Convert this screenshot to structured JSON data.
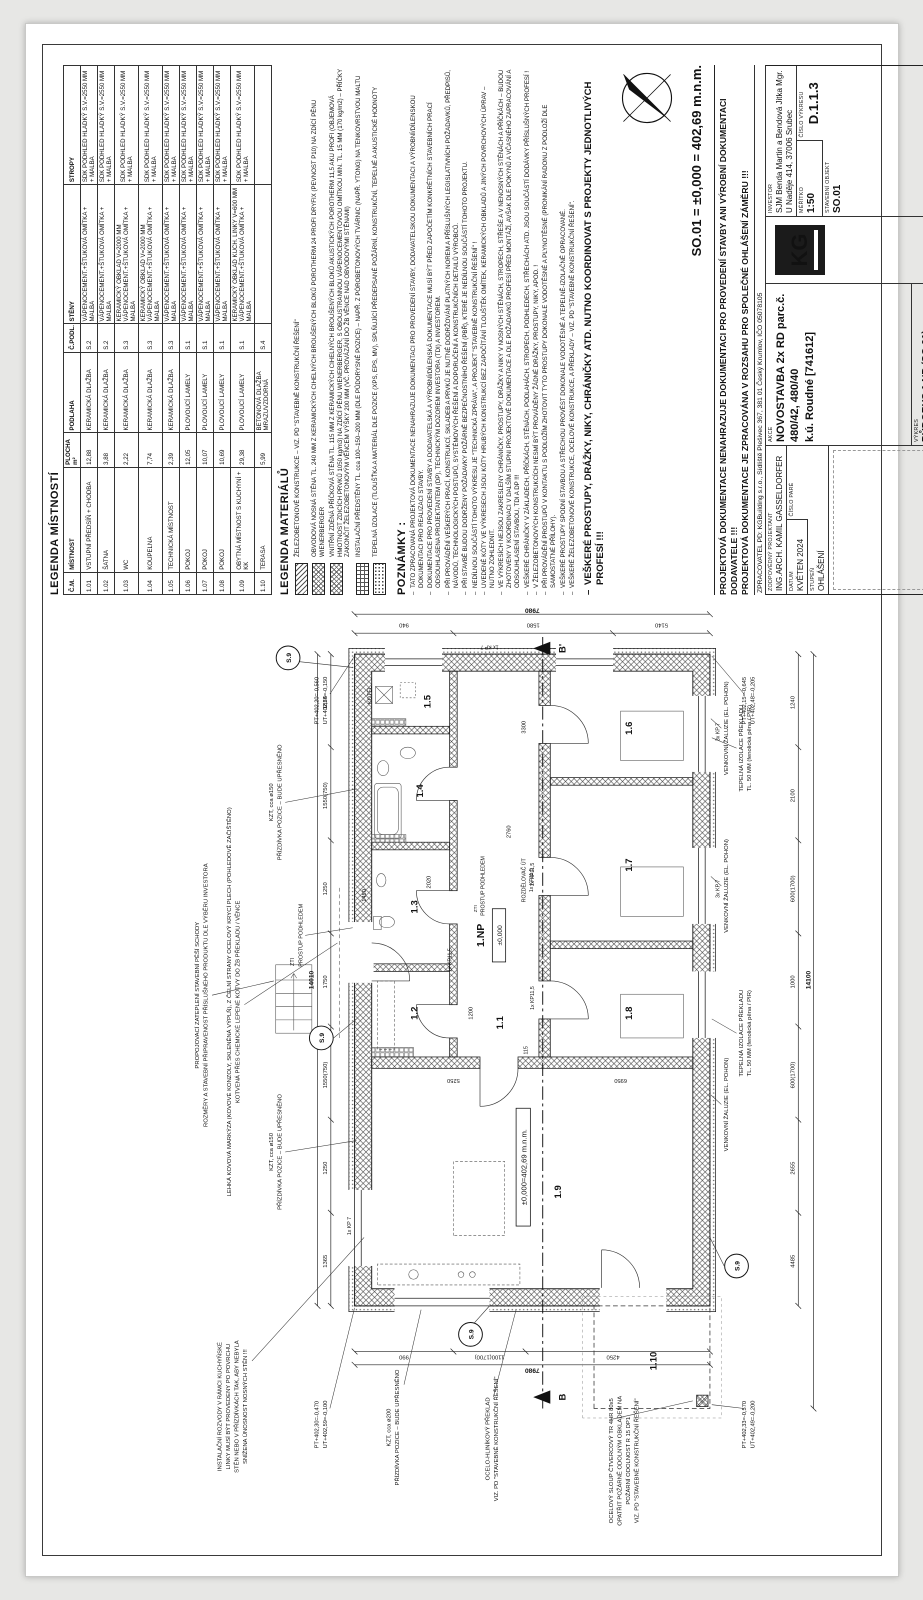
{
  "sheet": {
    "so_line": "SO.01 = ±0,000 = 402,69 m.n.m."
  },
  "room_table": {
    "title": "LEGENDA MÍSTNOSTÍ",
    "headers": [
      "Č.M.",
      "MÍSTNOST",
      "PLOCHA m²",
      "PODLAHA",
      "Č.PODL.",
      "STĚNY",
      "STROPY"
    ],
    "rows": [
      [
        "1.01",
        "VSTUPNÍ PŘEDSÍŇ + CHODBA",
        "12,88",
        "KERAMICKÁ DLAŽBA",
        "S.2",
        "VÁPENOCEMENT.+ŠTUKOVÁ OMÍTKA + MALBA",
        "SDK PODHLED HLADKÝ S.V.=2550 MM + MALBA"
      ],
      [
        "1.02",
        "ŠATNA",
        "3,88",
        "KERAMICKÁ DLAŽBA",
        "S.2",
        "VÁPENOCEMENT.+ŠTUKOVÁ OMÍTKA + MALBA",
        "SDK PODHLED HLADKÝ S.V.=2550 MM + MALBA"
      ],
      [
        "1.03",
        "WC",
        "2,22",
        "KERAMICKÁ DLAŽBA",
        "S.3",
        "KERAMICKÝ OBKLAD V=2000 MM\nVÁPENOCEMENT.+ŠTUKOVÁ OMÍTKA + MALBA",
        "SDK PODHLED HLADKÝ S.V.=2550 MM + MALBA"
      ],
      [
        "1.04",
        "KOUPELNA",
        "7,74",
        "KERAMICKÁ DLAŽBA",
        "S.3",
        "KERAMICKÝ OBKLAD V=2000 MM\nVÁPENOCEMENT.+ŠTUKOVÁ OMÍTKA + MALBA",
        "SDK PODHLED HLADKÝ S.V.=2550 MM + MALBA"
      ],
      [
        "1.05",
        "TECHNICKÁ MÍSTNOST",
        "2,39",
        "KERAMICKÁ DLAŽBA",
        "S.3",
        "VÁPENOCEMENT.+ŠTUKOVÁ OMÍTKA + MALBA",
        "SDK PODHLED HLADKÝ S.V.=2550 MM + MALBA"
      ],
      [
        "1.06",
        "POKOJ",
        "12,05",
        "PLOVOUCÍ LAMELY",
        "S.1",
        "VÁPENOCEMENT.+ŠTUKOVÁ OMÍTKA + MALBA",
        "SDK PODHLED HLADKÝ S.V.=2550 MM + MALBA"
      ],
      [
        "1.07",
        "POKOJ",
        "10,07",
        "PLOVOUCÍ LAMELY",
        "S.1",
        "VÁPENOCEMENT.+ŠTUKOVÁ OMÍTKA + MALBA",
        "SDK PODHLED HLADKÝ S.V.=2550 MM + MALBA"
      ],
      [
        "1.08",
        "POKOJ",
        "10,69",
        "PLOVOUCÍ LAMELY",
        "S.1",
        "VÁPENOCEMENT.+ŠTUKOVÁ OMÍTKA + MALBA",
        "SDK PODHLED HLADKÝ S.V.=2550 MM + MALBA"
      ],
      [
        "1.09",
        "OBYTNÁ MÍSTNOST S KUCHYNÍ + KK",
        "29,38",
        "PLOVOUCÍ LAMELY",
        "S.1",
        "KERAMICKÝ OBKLAD KUCH. LINKY V=600 MM\nVÁPENOCEMENT.+ŠTUKOVÁ OMÍTKA + MALBA",
        "SDK PODHLED HLADKÝ S.V.=2550 MM + MALBA"
      ],
      [
        "1.10",
        "TERASA",
        "5,99",
        "BETONOVÁ DLAŽBA MRAZUVZDORNÁ",
        "S.4",
        "",
        ""
      ]
    ]
  },
  "materials_legend": {
    "title": "LEGENDA MATERIÁLŮ",
    "items": [
      {
        "hatch": "diag",
        "text": "ŽELEZOBETONOVÉ KONSTRUKCE – VIZ. PD \"STAVEBNĚ KONSTRUKČNÍ ŘEŠENÍ\""
      },
      {
        "hatch": "cross",
        "text": "OBVODOVÁ NOSNÁ STĚNA TL. 240 MM Z KERAMICKÝCH CIHELNÝCH BROUŠENÝCH BLOKŮ POROTHERM 24 PROFI DRYFIX (PEVNOST P10) NA ZDÍCÍ PĚNU WIENERBERGER"
      },
      {
        "hatch": "cross",
        "text": "VNITŘNÍ ZDĚNÁ PŘÍČKOVÁ STĚNA TL. 115 MM Z KERAMICKÝCH CIHELNÝCH BROUŠENÝCH BLOKŮ AKUSTICKÝCH POROTHERM 11,5 AKU PROFI (OBJEMOVÁ HMOTNOST ZDICÍCH PRVKŮ 1050 kg/m3) NA ZDÍCÍ PĚNU WIENERBERGER, S OBOUSTRANNOU VÁPENOCEMENTOVOU OMÍTKOU MIN. TL. 15 MM (170 kg/m2) – PŘÍČKY ZAKONČIT ŽELEZOBETONOVÝM VĚNCEM VÝŠKY 200 MM (VČ. PROVÁZÁNÍ DO ŽB VĚNCE NAD OBVODOVÝMI STĚNAMI)"
      },
      {
        "hatch": "blocks",
        "text": "INSTALAČNÍ PŘEDSTĚNY TL. cca 100–150–200 MM (DLE PŮDORYSNÉ POZICE) – NAPŘ. Z PÓROBETONOVÝCH TVÁRNIC (NAPŘ. YTONG) NA TENKOVRSTVOU MALTU"
      },
      {
        "hatch": "dots",
        "text": "TEPELNÁ IZOLACE (TLOUŠŤKA A MATERIÁL DLE POZICE (XPS, EPS, MV), SPLŇUJÍCÍ PŘEDEPSANÉ POŽÁRNÍ, KONSTRUKČNÍ, TEPELNÉ A AKUSTICKÉ HODNOTY"
      }
    ]
  },
  "notes": {
    "title": "POZNÁMKY :",
    "items": [
      "TATO ZPRACOVANÁ PROJEKTOVÁ DOKUMENTACE NENAHRAZUJE DOKUMENTACI PRO PROVEDENÍ STAVBY, DODAVATELSKOU DOKUMENTACI A VÝROBNÍ/DÍLENSKOU DOKUMENTACI PRO REALIZACI STAVBY.",
      "DOKUMENTACE PRO PROVEDENÍ STAVBY A DODAVATELSKÁ A VÝROBNÍ/DÍLENSKÁ DOKUMENTACE MUSÍ BÝT PŘED ZAPOČETÍM KONKRÉTNÍCH STAVEBNÍCH PRACÍ ODSOUHLASENA PROJEKTANTEM (DP), TECHNICKÝM DOZOREM INVESTORA (TDI) A INVESTOREM.",
      "PŘI PROVÁDĚNÍ VEŠKERÝCH PRACÍ, KONSTRUKCÍ, SKLADEB A PRVKŮ JE NUTNÉ DODRŽOVÁNÍ PLATNÝCH NOREM A PŘÍSLUŠNÝCH LEGISLATIVNÍCH POŽADAVKŮ, PŘEDPISŮ, NÁVODŮ, TECHNOLOGICKÝCH POSTUPŮ, SYSTÉMOVÝCH ŘEŠENÍ A DOPORUČENÍ A KONSTRUKČNÍCH DETAILŮ VÝROBCŮ.",
      "PŘI STAVBĚ BUDOU DODRŽENY POŽADAVKY POŽÁRNĚ BEZPEČNOSTNÍHO ŘEŠENÍ (PBŘ), KTERÉ JE NEDÍLNOU SOUČÁSTÍ TOHOTO PROJEKTU.",
      "NEDÍLNOU SOUČÁSTÍ TOHOTO VÝKRESU JE \"TECHNICKÁ ZPRÁVA\", A PROJEKT \"STAVEBNĚ KONSTRUKČNÍ ŘEŠENÍ\" !",
      "UVEDENÉ KÓTY VE VÝKRESECH JSOU KÓTY HRUBÝCH KONSTRUKCÍ BEZ ZAPOČÍTÁNÍ TLOUŠTĚK OMÍTEK, KERAMICKÝCH OBKLADŮ A JINÝCH POVRCHOVÝCH ÚPRAV – NUTNO ZOHLEDNIT.",
      "VE VÝKRESÍCH NEJSOU ZAKRESLENY CHRÁNIČKY, PROSTUPY, DRÁŽKY A NIKY V NOSNÝCH STĚNÁCH, STROPECH, STŘEŠE A V NENOSNÝCH STĚNÁCH A PŘÍČKÁCH – BUDOU ZHOTOVENY V KOORDINACI V DALŠÍM STUPNI PROJEKTOVÉ DOKUMENTACE A DLE POŽADAVKŮ PROFESÍ PŘED MONTÁŽÍ, AVŠAK DLE POKYNŮ A VČASNÉHO ZAPRACOVÁNÍ A ODSOUHLASENÍ STAVBOU, TDI A DP !!!",
      "VEŠKERÉ CHRÁNIČKY V ZÁKLADECH, PŘÍČKÁCH, STĚNÁCH, PODLAHÁCH, STROPECH, PODHLEDECH, STŘECHÁCH ATD. JSOU SOUČÁSTÍ DODÁVKY PŘÍSLUŠNÝCH PROFESÍ !",
      "V ŽELEZOBETONOVÝCH KONSTRUKCÍCH NESMÍ BÝT PROVÁDĚNY ŽÁDNÉ DRÁŽKY, PROSTUPY, NIKY, APOD. !",
      "PŘI PROVÁDĚNÍ PROSTUPŮ V KONTAKTU S PODLOŽÍM ZHOTOVIT TYTO PROSTUPY DOKONALE VODOTĚSNÉ A PLYNOTĚSNÉ (PRONIKÁNÍ RADONU Z PODLOŽÍ DLE SAMOSTATNÉ PŘÍLOHY).",
      "VEŠKERÉ PROSTUPY SPODNÍ STAVBOU A STŘECHOU PROVÉST DOKONALE VODOTĚSNÉ A TEPELNĚ-IZOLAČNĚ OPRACOVANÉ.",
      "VEŠKERÉ ŽELEZOBETONOVÉ KONSTRUKCE, OCELOVÉ KONSTRUKCE, A PŘEKLADY – VIZ. PD \"STAVEBNĚ KONSTRUKČNÍ ŘEŠENÍ\"."
    ],
    "final": "VEŠKERÉ PROSTUPY, DRÁŽKY, NIKY, CHRÁNIČKY ATD. NUTNO KOORDINOVAT S PROJEKTY JEDNOTLIVÝCH PROFESÍ !!!"
  },
  "title_block": {
    "warning1": "PROJEKTOVÁ DOKUMENTACE NENAHRAZUJE DOKUMENTACI PRO PROVEDENÍ STAVBY ANI VÝROBNÍ DOKUMENTACI DODAVATELE !!!",
    "warning2": "PROJEKTOVÁ DOKUMENTACE JE ZPRACOVÁNA V ROZSAHU PRO SPOLEČNÉ OHLÁŠENÍ ZÁMĚRU !!!",
    "zpracovatel": "ZPRACOVATEL PD: KGBuilding s.r.o., Sídliště Plešivec 367, 381 01 Český Krumlov, IČO 05078105",
    "zodpovedny_label": "ZODPOVĚDNÝ PROJEKTANT",
    "zodpovedny": "ING.ARCH. KAMIL GASSELDORFER",
    "datum_label": "DATUM",
    "datum": "KVĚTEN 2024",
    "cislo_pare_label": "ČÍSLO PARÉ",
    "stupen_label": "STUPEŇ",
    "stupen": "OHLÁŠENÍ",
    "akce_label": "AKCE",
    "akce_line1": "NOVOSTAVBA 2x RD parc.č. 480/42, 480/40",
    "akce_line2": "k.ú. Roudné [741612]",
    "vykres_label": "VÝKRES",
    "vykres": "PŮDORYS 1.NP (SO.01)",
    "investor_label": "INVESTOR",
    "investor_line1": "SJM Benda Martin a Bendová Jitka Mgr.",
    "investor_line2": "U Naděje 414, 37006 Srubec",
    "meritko_label": "MĚŘÍTKO",
    "meritko": "1:50",
    "cislo_vykresu_label": "ČÍSLO VÝKRESU",
    "cislo_vykresu": "D.1.1.3",
    "stavebni_objekt_label": "STAVEBNÍ OBJEKT",
    "stavebni_objekt": "SO.01",
    "logo_text": "KG"
  },
  "plan": {
    "rooms": [
      "1.1",
      "1.2",
      "1.3",
      "1.4",
      "1.5",
      "1.6",
      "1.7",
      "1.8",
      "1.9",
      "1.10"
    ],
    "floor_label": "1.NP",
    "level_main": "±0,000=402,69 m.n.m.",
    "level_small": "±0,000",
    "section_marker": "S.9",
    "section_b": "B",
    "section_b2": "B'",
    "dims": {
      "top_overall": "14010",
      "top": [
        "1365",
        "1250",
        "1550(750)",
        "1750",
        "1250",
        "1550(750)",
        "1825"
      ],
      "bottom_overall": "14100",
      "bottom": [
        "4485",
        "2655",
        "600(1700)",
        "1000",
        "600(1700)",
        "2100",
        "1240"
      ],
      "left_overall": "7980",
      "left": [
        "990",
        "1100(1700)",
        "4250"
      ],
      "right_overall": "7980",
      "right": [
        "940",
        "1580",
        "5140"
      ],
      "inner": [
        "5250",
        "6950",
        "1200",
        "2760",
        "3300",
        "1450",
        "115",
        "2020"
      ]
    },
    "corner_levels": [
      {
        "pt": "PT+402,30=-0,470",
        "ut": "UT+402,59=-0,100"
      },
      {
        "pt": "PT+402,33=-0,570",
        "ut": "UT+402,49=-0,200"
      },
      {
        "pt": "PT+402,20=-0,560",
        "ut": "UT+402,54=-0,150"
      },
      {
        "pt": "PT+402,15=-0,645",
        "ut": "UT+402,48=-0,205"
      }
    ],
    "kp_marks": {
      "kp115": "1x KP11,5",
      "kp7": "1x KP 7",
      "kp7_3": "3x KP 7"
    },
    "callouts": {
      "instal": [
        "INSTALAČNÍ ROZVODY V RÁMCI KUCHYŇSKÉ",
        "LINKY MUSÍ BÝT PROVEDENY PO POVRCHU",
        "STĚN NEBO V PŘÍZDÍVKÁCH TAK, ABY NEBYLA",
        "SNÍŽENA ÚNOSNOST NOSNÝCH STĚN !!!"
      ],
      "schody": [
        "PROPOJOVACÍ ZATEPLENÍ STAVEBNÍ PĚŠÍ SCHODY",
        "ROZMĚRY A STAVEBNÍ PŘIPRAVENOST PŘÍSLUŠNÉHO PRODUKTU DLE VÝBĚRU INVESTORA"
      ],
      "markyza": [
        "LEHKÁ KOVOVÁ MARKÝZA (KOVOVÉ KONZOLY, SKLENĚNÁ VÝPLŇ), Z ČELNÍ STRANY OCELOVÝ KRYCÍ PLECH (POHLEDOVĚ ZAČIŠTĚNO)",
        "KOTVENÁ PŘES CHEMICKÉ LEPENÉ KOTVY DO ŽB PŘEKLADU / VĚNCE"
      ],
      "kzt150": [
        "KZT, cca ø150",
        "PŘÍZDÍVKA POZICE – BUDE UPŘESNĚNO"
      ],
      "kzt200": [
        "KZT, cca ø200",
        "PŘÍZDÍVKA POZICE – BUDE UPŘESNĚNO"
      ],
      "prostup": "PROSTUP PODHLEDEM",
      "zti": "ZTI",
      "zaluzie": "VENKOVNÍ ŽALUZIE (EL. POHON)",
      "ti_preklad": [
        "TEPELNÁ IZOLACE PŘEKLADU",
        "TL. 50 MM (fenolická pěna / PIR)"
      ],
      "preklad": [
        "OCELO-HLINÍKOVÝ PŘEKLAD",
        "VIZ. PD \"STAVEBNĚ KONSTRUKČNÍ ŘEŠENÍ\""
      ],
      "sloup": [
        "OCELOVÝ SLOUP ČTVERCOVÝ TR 4HR 80x5",
        "OPATŘIT POŽÁRNĚ ODOLNÝM OBKLADEM NA",
        "POŽÁRNÍ ODOLNOST R 15 DP1",
        "VIZ. PD \"STAVEBNĚ KONSTRUKČNÍ ŘEŠENÍ\""
      ],
      "rozdelovac": [
        "ROZDĚLOVAČ ÚT",
        "1x KP11,5"
      ],
      "kotel": "KOTEL"
    }
  }
}
